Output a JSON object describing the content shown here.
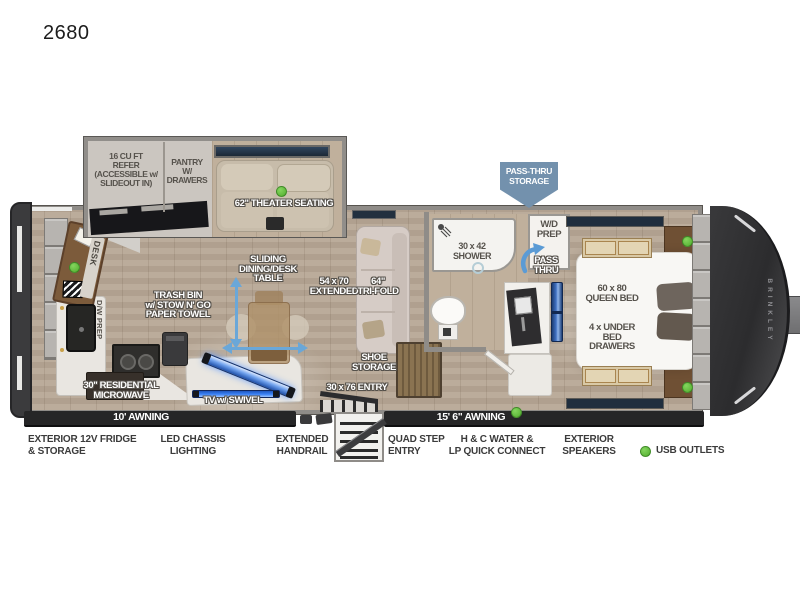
{
  "title": "2680",
  "slideout": {
    "refer": "16 CU FT\nREFER\n(ACCESSIBLE w/\nSLIDEOUT IN)",
    "pantry": "PANTRY\nW/\nDRAWERS",
    "theater": "62\" THEATER SEATING"
  },
  "callouts": {
    "pass_thru_storage": "PASS-THRU\nSTORAGE",
    "wd_prep": "W/D\nPREP",
    "pass_thru": "PASS\nTHRU",
    "shower": "30 x 42\nSHOWER",
    "queen_bed": "60 x 80\nQUEEN BED",
    "under_bed": "4 x UNDER BED\nDRAWERS",
    "sliding_table": "SLIDING\nDINING/DESK\nTABLE",
    "extended": "54 x 70\nEXTENDED",
    "tri_fold": "64\"\nTRI-FOLD",
    "trash": "TRASH BIN\nw/ STOW N' GO\nPAPER TOWEL",
    "desk": "DESK",
    "dw_prep": "D/W PREP",
    "microwave": "30\" RESIDENTIAL\nMICROWAVE",
    "tv": "TV w/ SWIVEL",
    "shoe": "SHOE\nSTORAGE",
    "entry": "30 x 76 ENTRY",
    "awning_left": "10' AWNING",
    "awning_right": "15' 6\" AWNING",
    "brand": "BRINKLEY"
  },
  "exterior": [
    "EXTERIOR 12V FRIDGE\n& STORAGE",
    "LED CHASSIS\nLIGHTING",
    "EXTENDED\nHANDRAIL",
    "QUAD STEP\nENTRY",
    "H & C WATER &\nLP QUICK CONNECT",
    "EXTERIOR\nSPEAKERS"
  ],
  "legend": {
    "usb_label": "USB OUTLETS"
  },
  "colors": {
    "usb_green": "#5cbb3c",
    "arrow_blue": "#6aa7d8",
    "banner_blue": "#7391ad",
    "tv_blue": "#3b82f6",
    "awning_black": "#262627",
    "wall_gray": "#8f8c88",
    "floor_wood": "#b7a795",
    "label_outline": "#55514b"
  }
}
